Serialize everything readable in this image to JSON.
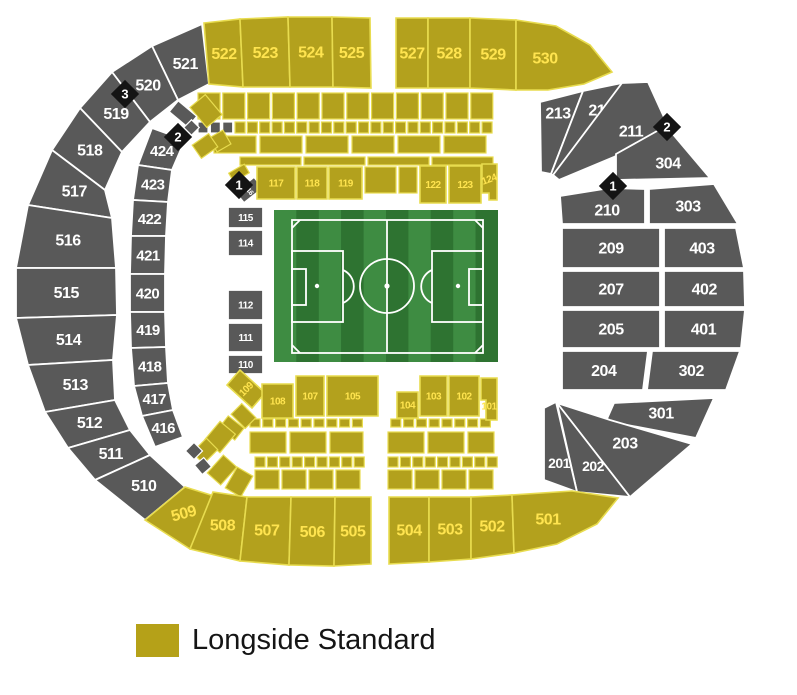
{
  "legend": {
    "label": "Longside Standard",
    "swatch_color": "#b5a118"
  },
  "colors": {
    "longside_yellow": "#b3a11d",
    "yellow_divider": "#e8dc4f",
    "standard_gray": "#595959",
    "label_yellow": "#ffe44f",
    "label_white": "#ffffff",
    "marker_black": "#141414",
    "pitch_green_light": "#3e8c42",
    "pitch_green_dark": "#2e7331",
    "pitch_line_white": "#ffffff"
  },
  "markers": [
    {
      "n": "3",
      "x": 125,
      "y": 94
    },
    {
      "n": "2",
      "x": 178,
      "y": 137
    },
    {
      "n": "1",
      "x": 239,
      "y": 185
    },
    {
      "n": "2",
      "x": 667,
      "y": 127
    },
    {
      "n": "1",
      "x": 613,
      "y": 186
    }
  ],
  "map": {
    "sections": [
      {
        "n": "521",
        "c": "g",
        "fs": 16,
        "p": "202,24 152,46 178,100 209,84"
      },
      {
        "n": "520",
        "c": "g",
        "fs": 16,
        "p": "152,46 112,72 150,122 178,100"
      },
      {
        "n": "519",
        "c": "g",
        "fs": 16,
        "p": "112,72 80,108 122,152 150,122"
      },
      {
        "n": "518",
        "c": "g",
        "fs": 16,
        "p": "80,108 52,150 105,190 122,152"
      },
      {
        "n": "517",
        "c": "g",
        "fs": 16,
        "p": "52,150 28,205 112,218 105,190"
      },
      {
        "n": "516",
        "c": "g",
        "fs": 16,
        "p": "28,205 16,268 116,268 112,218"
      },
      {
        "n": "515",
        "c": "g",
        "fs": 16,
        "p": "16,268 16,318 117,315 116,268"
      },
      {
        "n": "514",
        "c": "g",
        "fs": 16,
        "p": "16,318 28,365 113,360 117,315"
      },
      {
        "n": "513",
        "c": "g",
        "fs": 16,
        "p": "28,365 45,412 115,400 113,360"
      },
      {
        "n": "512",
        "c": "g",
        "fs": 16,
        "p": "45,412 68,448 130,430 115,400"
      },
      {
        "n": "511",
        "c": "g",
        "fs": 16,
        "p": "68,448 95,480 150,455 130,430"
      },
      {
        "n": "510",
        "c": "g",
        "fs": 16,
        "p": "95,480 145,520 185,487 150,455"
      },
      {
        "n": "522",
        "c": "y",
        "fs": 16,
        "p": "204,23 240,19 243,87 209,84"
      },
      {
        "n": "523",
        "c": "y",
        "fs": 16,
        "p": "240,19 288,17 290,87 243,87"
      },
      {
        "n": "524",
        "c": "y",
        "fs": 16,
        "p": "288,17 332,17 333,87 290,87"
      },
      {
        "n": "525",
        "c": "y",
        "fs": 16,
        "p": "332,17 370,18 371,88 333,87"
      },
      {
        "n": "527",
        "c": "y",
        "fs": 16,
        "p": "396,18 428,18 428,88 396,88"
      },
      {
        "n": "528",
        "c": "y",
        "fs": 16,
        "p": "428,18 470,18 470,88 428,88"
      },
      {
        "n": "529",
        "c": "y",
        "fs": 16,
        "p": "470,18 516,20 516,90 470,88"
      },
      {
        "n": "530",
        "c": "y",
        "fs": 16,
        "lx": 545,
        "ly": 58,
        "p": "516,20 556,26 590,45 612,72 584,84 548,90 516,90"
      },
      {
        "n": "424",
        "c": "g",
        "fs": 15,
        "p": "152,128 138,165 172,170 185,140"
      },
      {
        "n": "423",
        "c": "g",
        "fs": 15,
        "p": "138,165 133,200 168,202 172,170"
      },
      {
        "n": "422",
        "c": "g",
        "fs": 15,
        "p": "133,200 131,236 166,236 168,202"
      },
      {
        "n": "421",
        "c": "g",
        "fs": 15,
        "p": "131,236 130,274 165,274 166,236"
      },
      {
        "n": "420",
        "c": "g",
        "fs": 15,
        "p": "130,274 130,312 165,312 165,274"
      },
      {
        "n": "419",
        "c": "g",
        "fs": 15,
        "p": "130,312 131,348 166,347 165,312"
      },
      {
        "n": "418",
        "c": "g",
        "fs": 15,
        "p": "131,348 134,386 168,383 166,347"
      },
      {
        "n": "417",
        "c": "g",
        "fs": 15,
        "p": "134,386 142,416 173,410 168,383"
      },
      {
        "n": "416",
        "c": "g",
        "fs": 15,
        "p": "142,416 155,447 183,437 173,410"
      },
      {
        "n": "213",
        "c": "g",
        "fs": 16,
        "lx": 558,
        "ly": 113,
        "p": "540,102 583,91 551,174 541,172"
      },
      {
        "n": "212",
        "c": "g",
        "fs": 16,
        "lx": 601,
        "ly": 110,
        "p": "583,91 622,83 558,179 551,174"
      },
      {
        "n": "211",
        "c": "g",
        "fs": 16,
        "lx": 631,
        "ly": 131,
        "p": "622,83 648,82 668,126 614,157 559,180 553,175"
      },
      {
        "n": "304",
        "c": "g",
        "fs": 16,
        "lx": 668,
        "ly": 163,
        "p": "616,154 666,126 710,178 616,180"
      },
      {
        "n": "303",
        "c": "g",
        "fs": 16,
        "lx": 688,
        "ly": 206,
        "p": "649,189 714,184 738,224 649,224"
      },
      {
        "n": "210",
        "c": "g",
        "fs": 16,
        "lx": 607,
        "ly": 210,
        "p": "560,196 610,188 645,189 645,224 562,224"
      },
      {
        "n": "209",
        "c": "g",
        "fs": 16,
        "p": "562,228 660,228 660,268 562,268"
      },
      {
        "n": "403",
        "c": "g",
        "fs": 16,
        "p": "664,228 736,228 744,268 664,268"
      },
      {
        "n": "207",
        "c": "g",
        "fs": 16,
        "p": "562,271 660,271 660,307 562,307"
      },
      {
        "n": "402",
        "c": "g",
        "fs": 16,
        "p": "664,271 744,271 745,307 664,307"
      },
      {
        "n": "205",
        "c": "g",
        "fs": 16,
        "p": "562,310 660,310 660,348 562,348"
      },
      {
        "n": "401",
        "c": "g",
        "fs": 16,
        "p": "664,310 745,310 741,348 664,348"
      },
      {
        "n": "204",
        "c": "g",
        "fs": 16,
        "p": "562,351 648,351 643,390 562,390"
      },
      {
        "n": "302",
        "c": "g",
        "fs": 16,
        "p": "652,351 740,351 726,390 647,390"
      },
      {
        "n": "301",
        "c": "g",
        "fs": 16,
        "lx": 661,
        "ly": 413,
        "p": "614,403 714,398 696,438 606,421"
      },
      {
        "n": "203",
        "c": "g",
        "fs": 16,
        "lx": 625,
        "ly": 443,
        "p": "557,403 610,420 692,444 630,497"
      },
      {
        "n": "202",
        "c": "g",
        "fs": 14,
        "lx": 593,
        "ly": 466,
        "p": "557,403 630,497 577,492"
      },
      {
        "n": "201",
        "c": "g",
        "fs": 14,
        "lx": 559,
        "ly": 463,
        "p": "556,402 577,492 544,480 544,408"
      },
      {
        "n": "509",
        "c": "y",
        "fs": 16,
        "lr": -15,
        "p": "145,520 190,549 214,496 185,487"
      },
      {
        "n": "508",
        "c": "y",
        "fs": 16,
        "p": "190,549 240,561 247,497 213,492"
      },
      {
        "n": "507",
        "c": "y",
        "fs": 16,
        "p": "240,561 289,565 291,497 247,497"
      },
      {
        "n": "506",
        "c": "y",
        "fs": 16,
        "p": "289,565 334,566 335,497 291,497"
      },
      {
        "n": "505",
        "c": "y",
        "fs": 16,
        "p": "334,566 371,564 371,497 335,497"
      },
      {
        "n": "504",
        "c": "y",
        "fs": 16,
        "p": "389,564 429,562 429,497 389,497"
      },
      {
        "n": "503",
        "c": "y",
        "fs": 16,
        "p": "429,562 471,559 471,497 429,497"
      },
      {
        "n": "502",
        "c": "y",
        "fs": 16,
        "p": "471,559 514,553 512,495 471,497"
      },
      {
        "n": "501",
        "c": "y",
        "fs": 16,
        "lx": 548,
        "ly": 519,
        "p": "514,553 557,544 597,524 618,498 572,491 512,495"
      },
      {
        "n": "116",
        "c": "g",
        "fs": 7,
        "lr": 50,
        "p": "254,177 263,188 244,203 235,192"
      },
      {
        "n": "115",
        "c": "g",
        "fs": 10,
        "p": "228,207 263,207 263,228 228,228"
      },
      {
        "n": "114",
        "c": "g",
        "fs": 10,
        "p": "228,230 263,230 263,256 228,256"
      },
      {
        "n": "112",
        "c": "g",
        "fs": 10,
        "p": "228,290 263,290 263,320 228,320"
      },
      {
        "n": "111",
        "c": "g",
        "fs": 10,
        "p": "228,323 263,323 263,352 228,352"
      },
      {
        "n": "110",
        "c": "g",
        "fs": 10,
        "p": "228,355 263,355 263,374 228,374"
      },
      {
        "n": "117",
        "c": "y",
        "fs": 10,
        "p": "257,167 295,167 295,199 257,199"
      },
      {
        "n": "118",
        "c": "y",
        "fs": 10,
        "p": "297,167 327,167 327,199 297,199"
      },
      {
        "n": "119",
        "c": "y",
        "fs": 10,
        "p": "329,167 362,167 362,199 329,199"
      },
      {
        "n": "122",
        "c": "y",
        "fs": 10,
        "p": "420,166 446,166 446,203 420,203"
      },
      {
        "n": "123",
        "c": "y",
        "fs": 10,
        "p": "449,166 481,166 481,203 449,203"
      },
      {
        "n": "124",
        "c": "y",
        "fs": 10,
        "lr": -20,
        "lx": 489,
        "ly": 179,
        "p": "482,164 497,164 497,200 489,200 489,193 482,193"
      },
      {
        "n": "109",
        "c": "y",
        "fs": 10,
        "lr": -45,
        "p": "227,385 240,370 265,393 252,408"
      },
      {
        "n": "108",
        "c": "y",
        "fs": 10,
        "p": "262,384 293,384 293,418 262,418"
      },
      {
        "n": "107",
        "c": "y",
        "fs": 10,
        "p": "296,376 324,376 324,416 296,416"
      },
      {
        "n": "105",
        "c": "y",
        "fs": 10,
        "p": "327,376 378,376 378,416 327,416"
      },
      {
        "n": "104",
        "c": "y",
        "fs": 10,
        "p": "397,392 418,392 418,418 397,418"
      },
      {
        "n": "103",
        "c": "y",
        "fs": 10,
        "p": "420,376 447,376 447,416 420,416"
      },
      {
        "n": "102",
        "c": "y",
        "fs": 10,
        "p": "449,376 479,376 479,416 449,416"
      },
      {
        "n": "101",
        "c": "y",
        "fs": 10,
        "lx": 489,
        "ly": 406,
        "p": "481,378 497,378 497,420 486,420 486,400 481,400"
      }
    ]
  }
}
